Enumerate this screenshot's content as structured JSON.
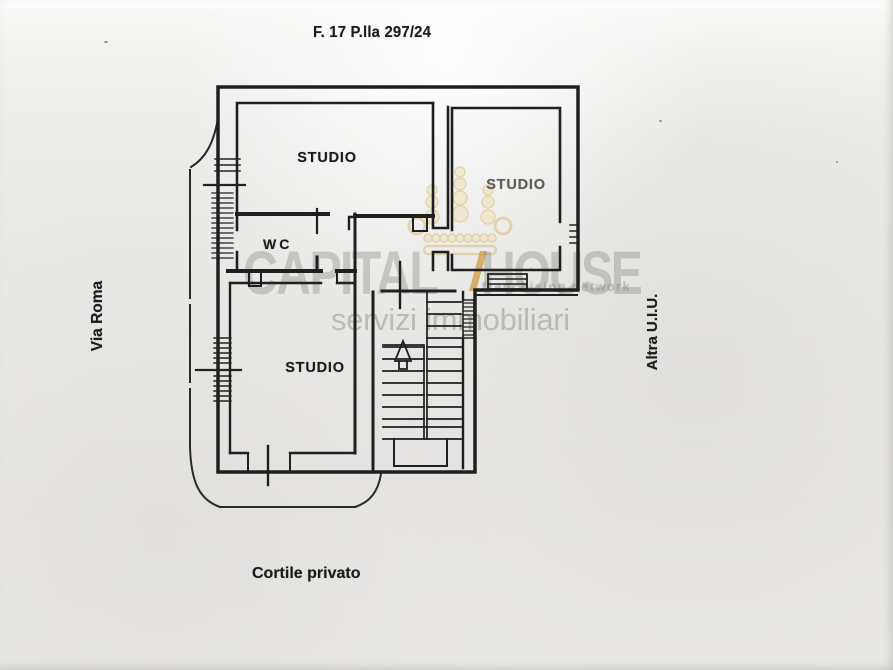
{
  "document": {
    "title": "F. 17 P.lla 297/24"
  },
  "plan": {
    "rooms": [
      {
        "id": "studio-top-left",
        "label": "STUDIO"
      },
      {
        "id": "studio-top-right",
        "label": "STUDIO"
      },
      {
        "id": "wc",
        "label": "WC"
      },
      {
        "id": "studio-bottom-left",
        "label": "STUDIO"
      }
    ],
    "annotations": {
      "left_street": "Via Roma",
      "right_adjacent_unit": "Altra U.I.U.",
      "bottom_courtyard": "Cortile privato"
    },
    "symbols": {
      "stairs_arrow": "up-direction-arrow"
    }
  },
  "watermark": {
    "brand_left": "CAPITAL",
    "brand_right": "HOUSE",
    "tagline": "franchising network",
    "subtitle": "servizi immobiliari",
    "colors": {
      "text": "#cfcfcc",
      "crown_gold": "#e7d5a2",
      "slash_gold": "#cd9637"
    }
  },
  "colors": {
    "ink": "#1f1f1f",
    "paper": "#ebebe9"
  }
}
